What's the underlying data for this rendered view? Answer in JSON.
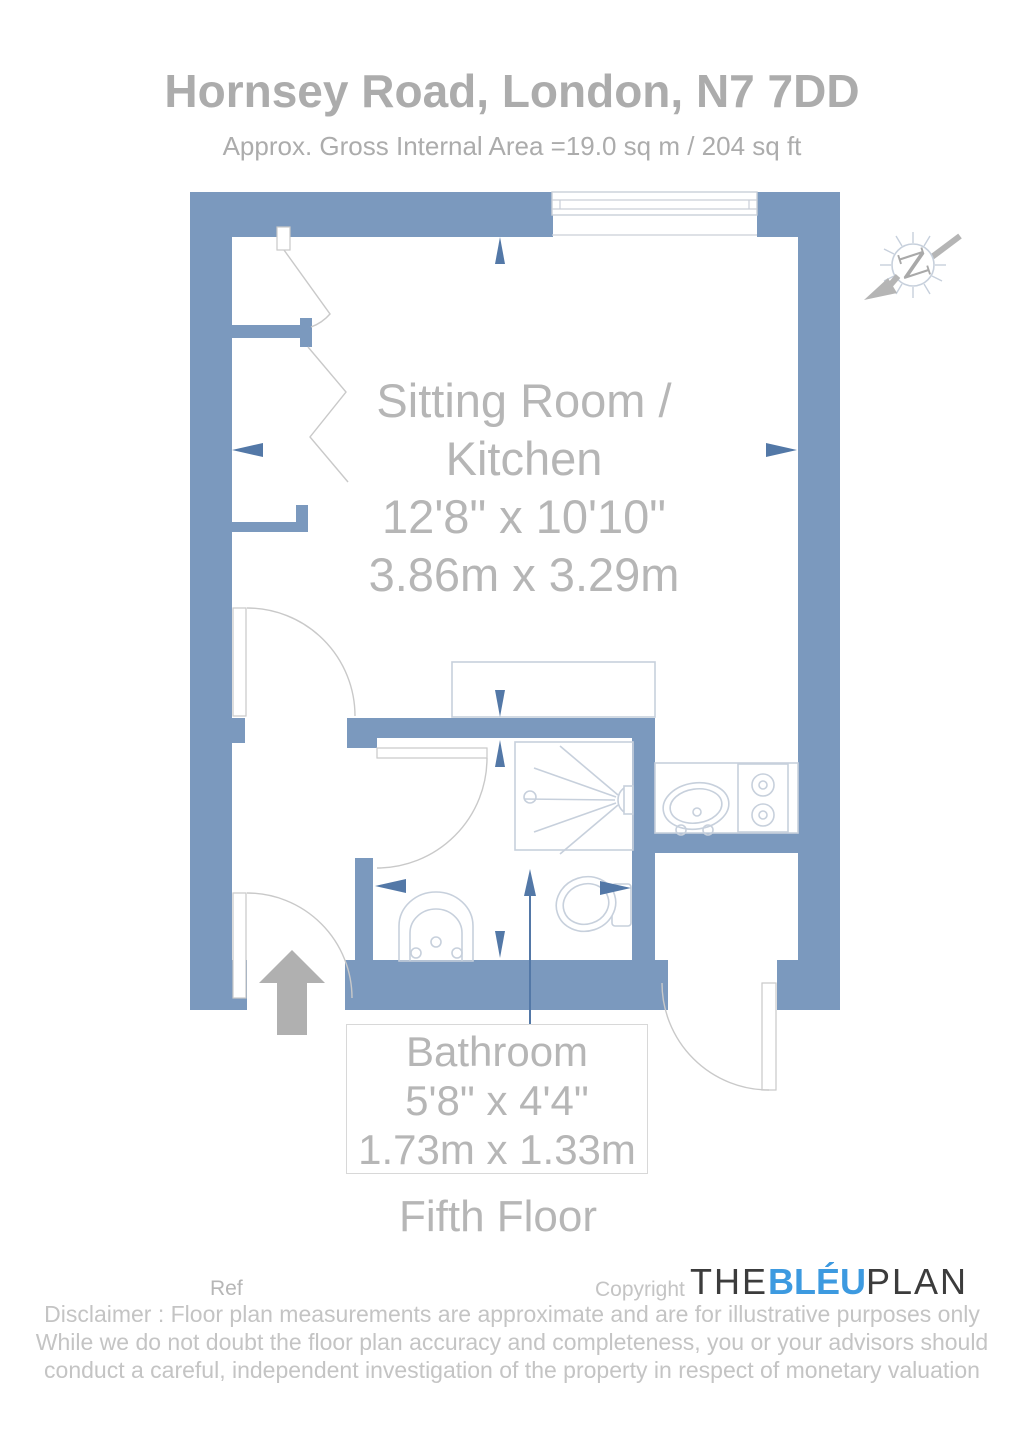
{
  "header": {
    "title": "Hornsey Road, London, N7 7DD",
    "subtitle": "Approx. Gross Internal Area =19.0 sq m / 204 sq ft"
  },
  "plan": {
    "sitting_room": {
      "label_line1": "Sitting Room /",
      "label_line2": "Kitchen",
      "size_imperial": "12'8\" x 10'10\"",
      "size_metric": "3.86m x 3.29m"
    },
    "bathroom": {
      "label": "Bathroom",
      "size_imperial": "5'8\" x 4'4\"",
      "size_metric": "1.73m x 1.33m"
    },
    "floor_label": "Fifth Floor",
    "compass_letter": "N"
  },
  "footer": {
    "ref_label": "Ref",
    "copyright_label": "Copyright",
    "brand_part1": "THE",
    "brand_part2": "BLÉU",
    "brand_part3": "PLAN",
    "disclaimer_line1": "Disclaimer : Floor plan measurements are approximate and are for illustrative purposes only",
    "disclaimer_line2": "While we do not doubt the floor plan accuracy and completeness, you or your advisors should",
    "disclaimer_line3": "conduct a careful, independent investigation of the property in respect of monetary valuation"
  },
  "colors": {
    "wall": "#7B99BE",
    "dimension_arrow": "#5378A7",
    "fixture_line": "#C7D0DC",
    "door_line": "#C9C9C9",
    "window_line": "#C9CFD8",
    "title_text": "#ACACAC",
    "label_text": "#B6B6B6",
    "disclaimer_text": "#C4C4C4",
    "brand_blue": "#3D9AE0",
    "brand_dark": "#3C3C3C",
    "north_gray": "#B5B5B5",
    "entrance_arrow": "#B0B0B0",
    "box_border": "#D8D8D8"
  }
}
